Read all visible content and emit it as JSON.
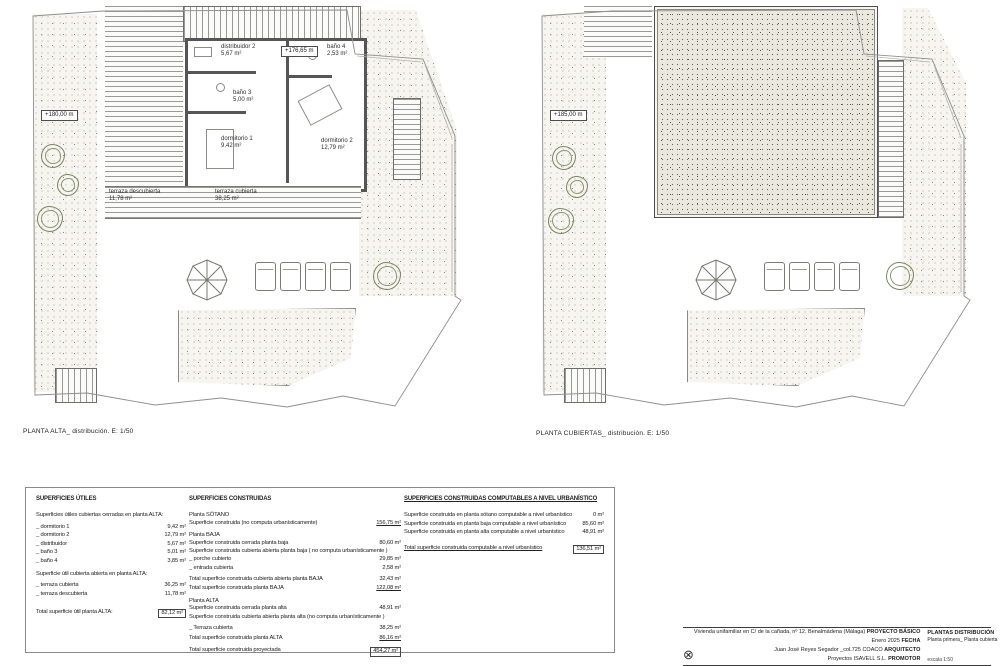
{
  "plan_left": {
    "caption": "PLANTA ALTA_ distribución. E: 1/50",
    "level_marker": "+180,00 m",
    "floor_level": "+176,65 m",
    "rooms": {
      "distribuidor": {
        "name": "distribuidor 2",
        "area": "5,67 m²"
      },
      "bano4": {
        "name": "baño 4",
        "area": "2,53 m²"
      },
      "bano3": {
        "name": "baño 3",
        "area": "5,00 m²"
      },
      "dormitorio1": {
        "name": "dormitorio 1",
        "area": "9,42 m²"
      },
      "dormitorio2": {
        "name": "dormitorio 2",
        "area": "12,79 m²"
      }
    },
    "terraza_descubierta": {
      "name": "terraza descubierta",
      "area": "11,78 m²"
    },
    "terraza_cubierta": {
      "name": "terraza cubierta",
      "area": "38,25 m²"
    }
  },
  "plan_right": {
    "caption": "PLANTA CUBIERTAS_ distribución. E: 1/50",
    "level_marker": "+185,00 m"
  },
  "superficies_utiles": {
    "title": "SUPERFICIES ÚTILES",
    "subtitle1": "Superficies útiles cubiertas cerradas en planta ALTA:",
    "rows1": [
      {
        "label": "_ dormitorio 1",
        "value": "9,42 m²"
      },
      {
        "label": "_ dormitorio 2",
        "value": "12,79 m²"
      },
      {
        "label": "_ distribuidor",
        "value": "5,67 m²"
      },
      {
        "label": "_ baño 3",
        "value": "5,01 m²"
      },
      {
        "label": "_ baño 4",
        "value": "3,85 m²"
      }
    ],
    "subtitle2": "Superficie útil cubierta abierta en planta ALTA:",
    "rows2": [
      {
        "label": "_ terraza cubierta",
        "value": "36,25 m²"
      },
      {
        "label": "_ terraza descubierta",
        "value": "11,78 m²"
      }
    ],
    "total_label": "Total superficie útil planta ALTA:",
    "total_value": "82,12 m²"
  },
  "superficies_construidas": {
    "title": "SUPERFICIES CONSTRUIDAS",
    "sotano_head": "Planta SÓTANO",
    "sotano_row": {
      "label": "Superficie construida (no computa urbanísticamente)",
      "value": "156,75 m²"
    },
    "baja_head": "Planta BAJA",
    "baja_cerrada": {
      "label": "Superficie construida cerrada planta baja",
      "value": "80,60 m²"
    },
    "baja_abierta_head": "Superficie construida cubierta abierta planta baja ( no computa urbanísticamente )",
    "porche": {
      "label": "_ porche cubierto",
      "value": "29,85 m²"
    },
    "entrada": {
      "label": "_ entrada cubierta",
      "value": "2,58 m²"
    },
    "total_abierta_baja": {
      "label": "Total superficie construida cubierta abierta planta BAJA",
      "value": "32,43 m²"
    },
    "total_baja": {
      "label": "Total superficie construida planta BAJA",
      "value": "122,08 m²"
    },
    "alta_head": "Planta ALTA",
    "alta_cerrada": {
      "label": "Superficie construida cerrada planta alta",
      "value": "48,91 m²"
    },
    "alta_abierta_head": "Superficie construida cubierta abierta planta alta (no computa urbanísticamente )",
    "terraza": {
      "label": "_ Terraza cubierta",
      "value": "38,25 m²"
    },
    "total_alta": {
      "label": "Total superficie construida planta ALTA",
      "value": "86,16 m²"
    },
    "total_proyectada": {
      "label": "Total superficie construida proyectada",
      "value": "454,27 m²"
    }
  },
  "computables": {
    "title": "SUPERFICIES CONSTRUIDAS COMPUTABLES A NIVEL URBANÍSTICO",
    "rows": [
      {
        "label": "Superficie construida en planta sótano computable a nivel urbanístico",
        "value": "0 m²"
      },
      {
        "label": "Superficie construida en planta baja computable a nivel urbanístico",
        "value": "85,60 m²"
      },
      {
        "label": "Superficie construida en planta alta computable a nivel urbanístico",
        "value": "48,91 m²"
      }
    ],
    "total_label": "Total superficie construida computable a nivel urbanístico",
    "total_value": "136,51 m²"
  },
  "title_block": {
    "project": "Vivienda unifamiliar en C/ de la cañada, nº 12, Benalmádena (Málaga)",
    "project_tag": "PROYECTO BÁSICO",
    "date": "Enero 2025",
    "date_tag": "FECHA",
    "architect": "Juan José Reyes Segador _col.725 COACO",
    "architect_tag": "ARQUITECTO",
    "promoter": "Proyectos ISAVELL S.L.",
    "promoter_tag": "PROMOTOR",
    "sheet_title": "PLANTAS DISTRIBUCIÓN",
    "sheet_subtitle": "Planta primera_ Planta cubierta",
    "scale": "escala 1:50",
    "sheet_number": "04"
  }
}
